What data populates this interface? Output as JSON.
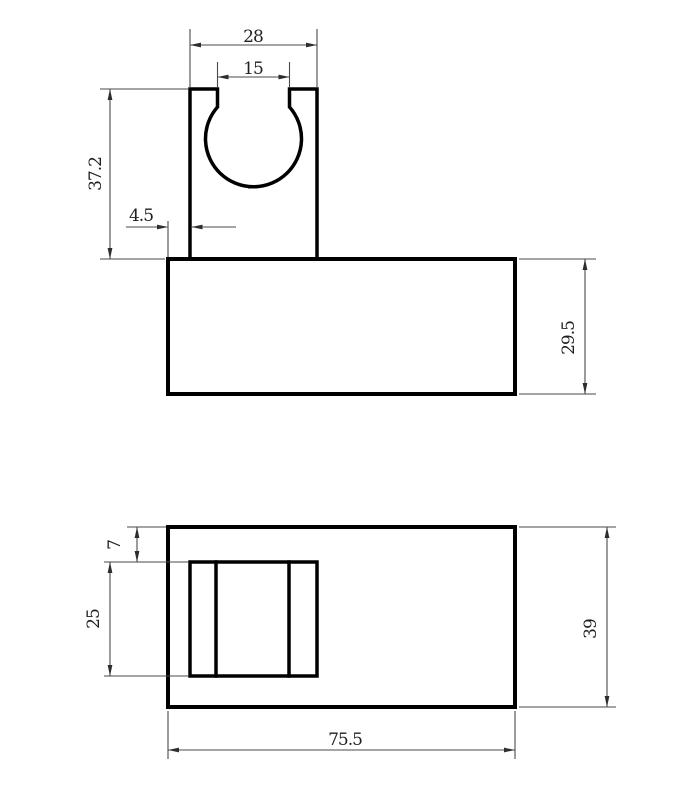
{
  "colors": {
    "background": "#ffffff",
    "object_line": "#000000",
    "dimension_line": "#4a4a4a",
    "dimension_text": "#1f1f1f"
  },
  "front_view": {
    "dim_upright_width": "28",
    "dim_slot_width": "15",
    "dim_upright_height": "37.2",
    "dim_wall_offset": "4.5",
    "dim_base_height": "29.5"
  },
  "bottom_view": {
    "dim_top_offset": "7",
    "dim_pocket_height": "25",
    "dim_overall_height": "39",
    "dim_overall_width": "75.5"
  }
}
